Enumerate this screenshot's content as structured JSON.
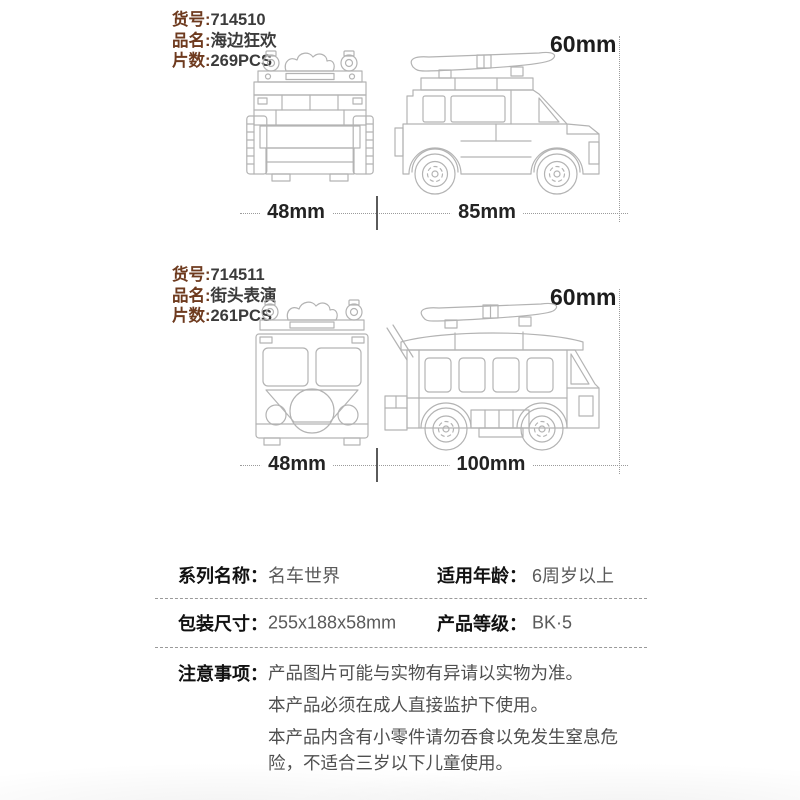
{
  "colors": {
    "label_brown": "#6e3a1e",
    "value_dark": "#3b3b3b",
    "dim_text": "#1d1d1d",
    "table_label": "#111111",
    "table_value": "#5a5a5a",
    "line_art": "#b3b3b3",
    "dim_line_gray": "#9b9b9b"
  },
  "products": [
    {
      "fields": [
        {
          "label": "货号:",
          "value": "714510"
        },
        {
          "label": "品名:",
          "value": "海边狂欢"
        },
        {
          "label": "片数:",
          "value": "269PCS"
        }
      ],
      "height_dim": "60mm",
      "width_dim": "48mm",
      "length_dim": "85mm"
    },
    {
      "fields": [
        {
          "label": "货号:",
          "value": "714511"
        },
        {
          "label": "品名:",
          "value": "街头表演"
        },
        {
          "label": "片数:",
          "value": "261PCS"
        }
      ],
      "height_dim": "60mm",
      "width_dim": "48mm",
      "length_dim": "100mm"
    }
  ],
  "spec_table": {
    "rows": [
      {
        "label_left": "系列名称：",
        "value_left": "名车世界",
        "label_right": "适用年龄：",
        "value_right": "6周岁以上"
      },
      {
        "label_left": "包装尺寸：",
        "value_left": "255x188x58mm",
        "label_right": "产品等级：",
        "value_right": "BK·5"
      }
    ],
    "notes_label": "注意事项：",
    "notes": [
      "产品图片可能与实物有异请以实物为准。",
      "本产品必须在成人直接监护下使用。",
      "本产品内含有小零件请勿吞食以免发生窒息危险，不适合三岁以下儿童使用。"
    ]
  }
}
